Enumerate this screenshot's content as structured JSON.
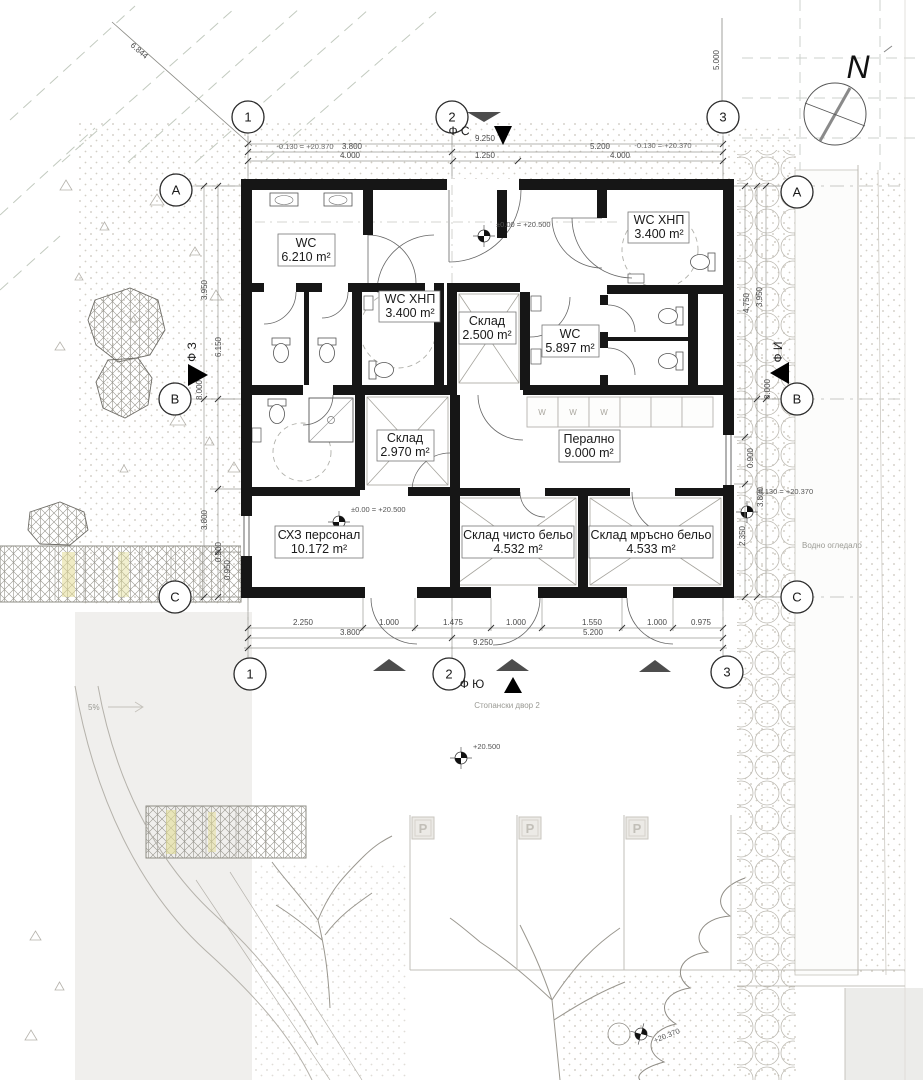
{
  "drawing": {
    "north_label": "N",
    "grid": {
      "c1": "1",
      "c2": "2",
      "c3": "3",
      "rA": "A",
      "rB": "B",
      "rC": "C"
    },
    "facades": {
      "north": "Ф С",
      "south": "Ф Ю",
      "west": "Ф З",
      "east": "Ф И"
    },
    "rooms": [
      {
        "name": "WC",
        "area": "6.210 m²"
      },
      {
        "name": "WC ХНП",
        "area": "3.400 m²"
      },
      {
        "name": "Склад",
        "area": "2.500 m²"
      },
      {
        "name": "WC",
        "area": "5.897 m²"
      },
      {
        "name": "WC ХНП",
        "area": "3.400 m²"
      },
      {
        "name": "Склад",
        "area": "2.970 m²"
      },
      {
        "name": "Перално",
        "area": "9.000 m²"
      },
      {
        "name": "СХЗ персонал",
        "area": "10.172 m²"
      },
      {
        "name": "Склад чисто бельо",
        "area": "4.532 m²"
      },
      {
        "name": "Склад мръсно бельо",
        "area": "4.533 m²"
      }
    ],
    "levels": {
      "interior": "±0.00 = +20.500",
      "yard": "+20.500",
      "pool": "+20.370",
      "offset_right": "-0.130 = +20.370",
      "offset_top_left": "-0.130 = +20.370",
      "offset_top_right": "-0.130 = +20.370"
    },
    "dims": {
      "top_total": "9.250",
      "top_row2": [
        "3.800",
        "5.200"
      ],
      "top_row3": [
        "4.000",
        "1.250",
        "4.000"
      ],
      "top_diag": "6.844",
      "top_right_vert": "5.000",
      "bottom_row1": [
        "2.250",
        "1.000",
        "1.475",
        "1.000",
        "1.550",
        "1.000",
        "0.975"
      ],
      "bottom_row2": [
        "3.800",
        "5.200"
      ],
      "bottom_total": "9.250",
      "left": [
        "3.950",
        "6.150",
        "8.000",
        "3.800",
        "0.900",
        "0.950"
      ],
      "right": [
        "3.950",
        "4.750",
        "8.000",
        "0.900",
        "3.800",
        "2.350"
      ]
    },
    "site": {
      "yard": "Стопански двор 2",
      "water": "Водно огледало",
      "slope": "5%",
      "parking": "P",
      "washer": "W"
    }
  }
}
